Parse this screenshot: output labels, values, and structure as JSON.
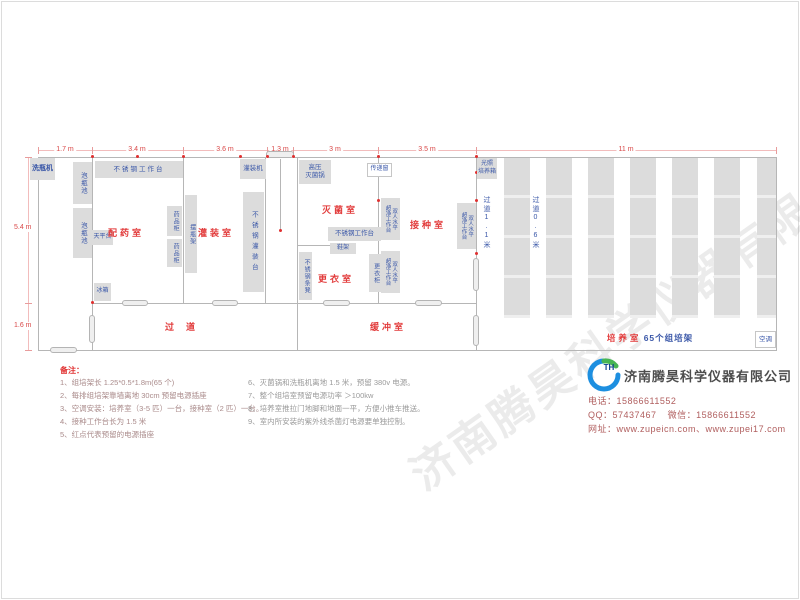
{
  "plan": {
    "dimensions": {
      "top": [
        "1.7 m",
        "3.4 m",
        "3.6 m",
        "1.3 m",
        "3 m",
        "3.5 m",
        "11 m"
      ],
      "left_upper": "5.4 m",
      "left_lower": "1.6 m"
    },
    "rooms": {
      "prep": "配药室",
      "filling": "灌装室",
      "sterilization": "灭菌室",
      "inoculation": "接种室",
      "changing": "更衣室",
      "corridor": "过道",
      "buffer": "缓冲室",
      "culture": "培养室",
      "culture_racks_note": "65个组培架"
    },
    "corridor_labels": {
      "c1": "过道1.1米",
      "c2": "过道0.6米"
    },
    "equipment": {
      "washer": "洗瓶机",
      "soak_pool": "泡瓶池",
      "worktable": "不锈钢工作台",
      "balance": "天平台",
      "fridge": "冰箱",
      "medicine_cabinet": "药品柜",
      "bottle_rack": "摆瓶架",
      "filling_table": "不锈钢灌装台",
      "filling_machine": "灌装机",
      "autoclave": "高压\n灭菌锅",
      "pass_window": "传递窗",
      "shoe_rack": "鞋架",
      "wardrobe": "更衣柜",
      "bench": "不锈钢条凳",
      "clean_bench": "双人水平\n超净工作台",
      "light_incubator": "光照\n培养箱",
      "air_conditioner": "空调"
    }
  },
  "notes": {
    "title": "备注：",
    "left": [
      "1、组培架长 1.25*0.5*1.8m(65 个)",
      "2、每排组培架靠墙离地 30cm 预留电源插座",
      "3、空调安装：培养室（3-5 匹）一台，接种室（2 匹）一台。",
      "4、接种工作台长为 1.5 米",
      "5、红点代表预留的电源插座"
    ],
    "right": [
      "6、灭菌锅和洗瓶机离地 1.5 米，预留 380v 电源。",
      "7、整个组培室预留电源功率 ＞100kw",
      "8、培养室推拉门地脚和地面一平，方便小推车推送。",
      "9、室内所安装的紫外线杀菌灯电源要单独控制。"
    ]
  },
  "company": {
    "logo_text": "TH",
    "name": "济南腾昊科学仪器有限公司",
    "phone_label": "电话：",
    "phone": "15866611552",
    "qq_label": "QQ：",
    "qq": "57437467",
    "wechat_label": "微信：",
    "wechat": "15866611552",
    "web_label": "网址：",
    "websites": "www.zupeicn.com、www.zupei17.com"
  },
  "watermark": "济南腾昊科学仪器有限公司"
}
